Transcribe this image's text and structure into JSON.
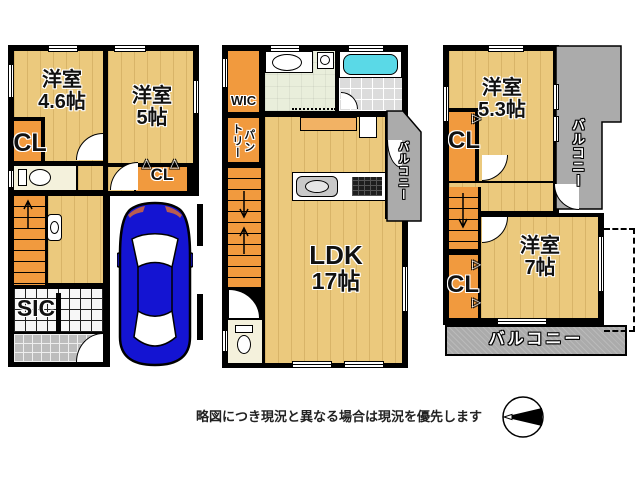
{
  "floor1": {
    "room1_name": "洋室",
    "room1_size": "4.6帖",
    "room2_name": "洋室",
    "room2_size": "5帖",
    "closet1": "CL",
    "closet2": "CL",
    "shoe_closet": "SIC"
  },
  "floor2": {
    "walk_in_closet": "WIC",
    "pantry_line1": "パン",
    "pantry_line2": "トリー",
    "living_name": "LDK",
    "living_size": "17帖",
    "balcony": "バルコニー"
  },
  "floor3": {
    "room1_name": "洋室",
    "room1_size": "5.3帖",
    "closet1": "CL",
    "room2_name": "洋室",
    "room2_size": "7帖",
    "closet2": "CL",
    "balcony_side": "バルコニー",
    "balcony_bottom": "バルコニー"
  },
  "footer": {
    "disclaimer": "略図につき現況と異なる場合は現況を優先します"
  },
  "icons": {
    "hanger_up": "△",
    "hanger_right": "▷"
  },
  "colors": {
    "wall": "#000000",
    "floor_wood": "#ebc97d",
    "closet_orange": "#f19a3e",
    "balcony_gray": "#ababab",
    "bath_cyan": "#5ad9e7",
    "car_blue": "#1414d2"
  }
}
